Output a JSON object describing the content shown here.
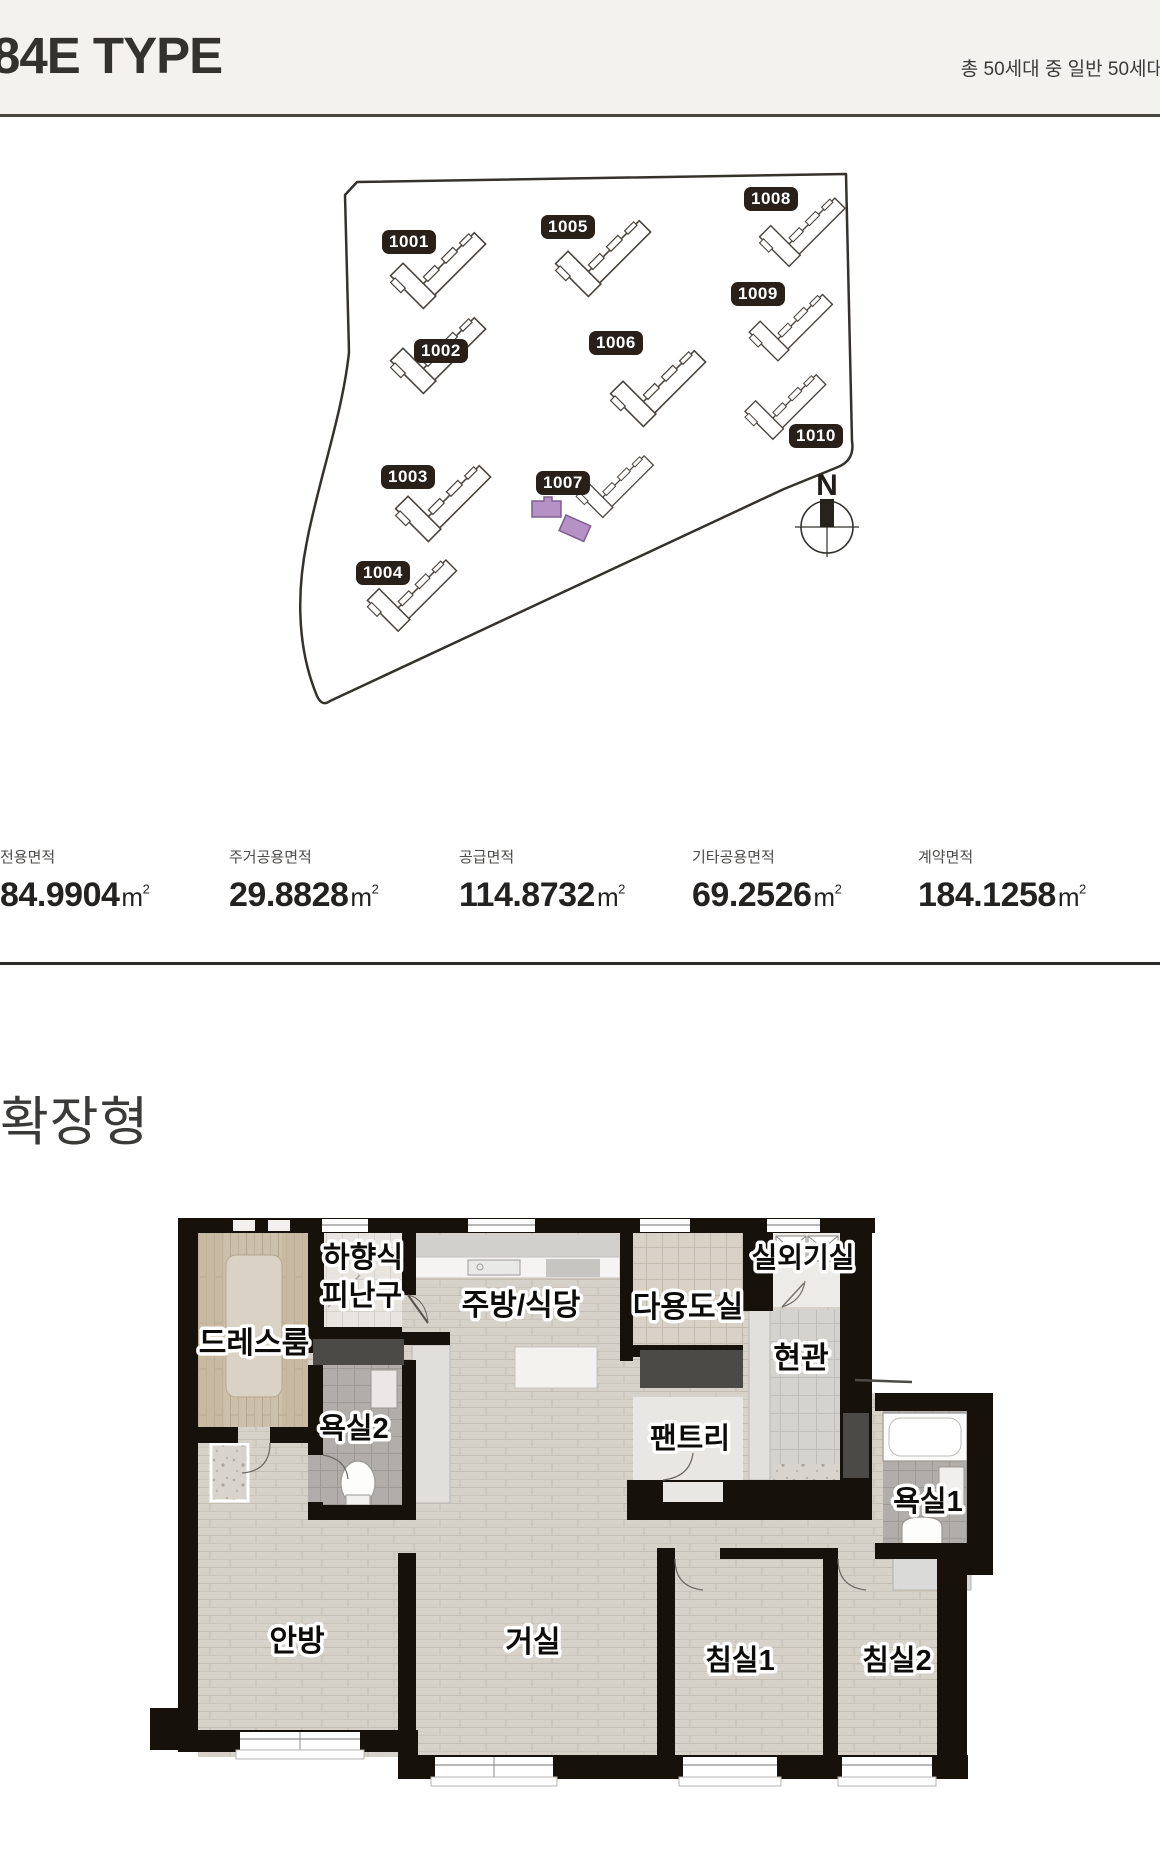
{
  "header": {
    "title": "84E TYPE",
    "subtitle": "총 50세대 중 일반 50세대"
  },
  "site_plan": {
    "compass": "N",
    "highlight_color": "#b691c5",
    "buildings": [
      {
        "label": "1001"
      },
      {
        "label": "1002"
      },
      {
        "label": "1003"
      },
      {
        "label": "1004"
      },
      {
        "label": "1005"
      },
      {
        "label": "1006"
      },
      {
        "label": "1007"
      },
      {
        "label": "1008"
      },
      {
        "label": "1009"
      },
      {
        "label": "1010"
      }
    ]
  },
  "area_stats": {
    "items": [
      {
        "label": "전용면적",
        "value": "84.9904",
        "unit": "m",
        "sup": "2"
      },
      {
        "label": "주거공용면적",
        "value": "29.8828",
        "unit": "m",
        "sup": "2"
      },
      {
        "label": "공급면적",
        "value": "114.8732",
        "unit": "m",
        "sup": "2"
      },
      {
        "label": "기타공용면적",
        "value": "69.2526",
        "unit": "m",
        "sup": "2"
      },
      {
        "label": "계약면적",
        "value": "184.1258",
        "unit": "m",
        "sup": "2"
      }
    ]
  },
  "floor_plan": {
    "heading": "확장형",
    "rooms": {
      "dressroom": "드레스룸",
      "hatch1": "하향식",
      "hatch2": "피난구",
      "kitchen": "주방/식당",
      "utility": "다용도실",
      "outdoor_unit": "실외기실",
      "entrance": "현관",
      "bath2": "욕실2",
      "pantry": "팬트리",
      "bath1": "욕실1",
      "master_bedroom": "안방",
      "living": "거실",
      "bedroom1": "침실1",
      "bedroom2": "침실2"
    }
  }
}
